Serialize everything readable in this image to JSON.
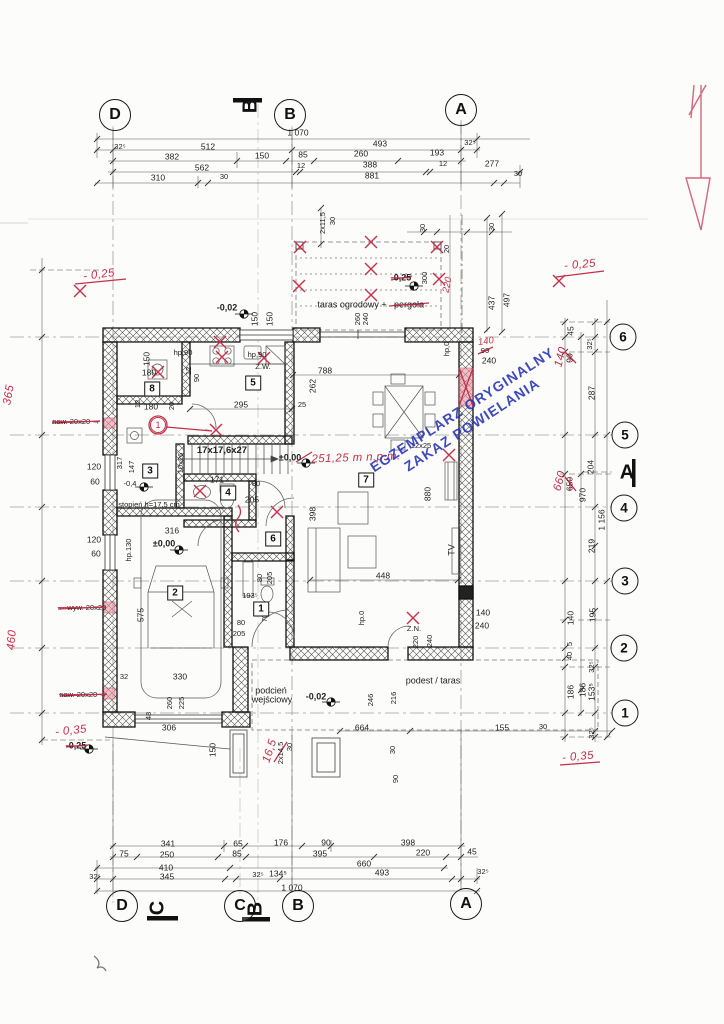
{
  "stamp": {
    "line1": "EGZEMPLARZ ORYGINALNY",
    "line2": "ZAKAZ POWIELANIA"
  },
  "bubbles": [
    {
      "t": "D",
      "x": 115,
      "y": 115
    },
    {
      "t": "B",
      "x": 290,
      "y": 115
    },
    {
      "t": "A",
      "x": 461,
      "y": 110
    },
    {
      "t": "D",
      "x": 122,
      "y": 906
    },
    {
      "t": "C",
      "x": 240,
      "y": 906
    },
    {
      "t": "B",
      "x": 298,
      "y": 906
    },
    {
      "t": "A",
      "x": 466,
      "y": 904
    },
    {
      "t": "6",
      "x": 623,
      "y": 337,
      "c": "s"
    },
    {
      "t": "5",
      "x": 625,
      "y": 435,
      "c": "s"
    },
    {
      "t": "4",
      "x": 624,
      "y": 508,
      "c": "s"
    },
    {
      "t": "3",
      "x": 625,
      "y": 581,
      "c": "s"
    },
    {
      "t": "2",
      "x": 624,
      "y": 648,
      "c": "s"
    },
    {
      "t": "1",
      "x": 625,
      "y": 713,
      "c": "s"
    }
  ],
  "sections": [
    {
      "t": "B",
      "x": 251,
      "y": 106,
      "r": -90
    },
    {
      "t": "C",
      "x": 158,
      "y": 908,
      "r": -90
    },
    {
      "t": "B",
      "x": 256,
      "y": 909,
      "r": -90
    },
    {
      "t": "A",
      "x": 627,
      "y": 473
    }
  ],
  "rooms": [
    {
      "t": "8",
      "x": 152,
      "y": 389
    },
    {
      "t": "5",
      "x": 253,
      "y": 383
    },
    {
      "t": "3",
      "x": 150,
      "y": 471
    },
    {
      "t": "4",
      "x": 228,
      "y": 493
    },
    {
      "t": "6",
      "x": 273,
      "y": 539
    },
    {
      "t": "2",
      "x": 175,
      "y": 593
    },
    {
      "t": "7",
      "x": 366,
      "y": 480
    },
    {
      "t": "1",
      "x": 261,
      "y": 609
    }
  ],
  "labels": [
    {
      "t": "1 070",
      "x": 298,
      "y": 133
    },
    {
      "t": "32⁵",
      "x": 120,
      "y": 147,
      "c": "sm"
    },
    {
      "t": "512",
      "x": 208,
      "y": 147
    },
    {
      "t": "493",
      "x": 380,
      "y": 144
    },
    {
      "t": "32⁵",
      "x": 470,
      "y": 143,
      "c": "sm"
    },
    {
      "t": "382",
      "x": 172,
      "y": 157
    },
    {
      "t": "150",
      "x": 262,
      "y": 156
    },
    {
      "t": "85",
      "x": 303,
      "y": 155
    },
    {
      "t": "260",
      "x": 361,
      "y": 154
    },
    {
      "t": "193",
      "x": 437,
      "y": 153
    },
    {
      "t": "562",
      "x": 202,
      "y": 168
    },
    {
      "t": "12",
      "x": 301,
      "y": 166,
      "c": "sm"
    },
    {
      "t": "388",
      "x": 370,
      "y": 165
    },
    {
      "t": "12",
      "x": 443,
      "y": 164,
      "c": "sm"
    },
    {
      "t": "277",
      "x": 492,
      "y": 164
    },
    {
      "t": "310",
      "x": 158,
      "y": 178
    },
    {
      "t": "30",
      "x": 224,
      "y": 177,
      "c": "sm"
    },
    {
      "t": "881",
      "x": 372,
      "y": 176
    },
    {
      "t": "30",
      "x": 518,
      "y": 174,
      "c": "sm"
    },
    {
      "t": "341",
      "x": 168,
      "y": 844
    },
    {
      "t": "65",
      "x": 238,
      "y": 844
    },
    {
      "t": "176",
      "x": 281,
      "y": 843
    },
    {
      "t": "90",
      "x": 326,
      "y": 843
    },
    {
      "t": "398",
      "x": 408,
      "y": 843
    },
    {
      "t": "75",
      "x": 124,
      "y": 854
    },
    {
      "t": "250",
      "x": 167,
      "y": 855
    },
    {
      "t": "85",
      "x": 237,
      "y": 854
    },
    {
      "t": "395",
      "x": 320,
      "y": 854
    },
    {
      "t": "220",
      "x": 423,
      "y": 853
    },
    {
      "t": "45",
      "x": 472,
      "y": 852
    },
    {
      "t": "410",
      "x": 166,
      "y": 868
    },
    {
      "t": "660",
      "x": 364,
      "y": 864
    },
    {
      "t": "32⁵",
      "x": 95,
      "y": 877,
      "c": "sm"
    },
    {
      "t": "345",
      "x": 167,
      "y": 877
    },
    {
      "t": "32⁵",
      "x": 258,
      "y": 875,
      "c": "sm"
    },
    {
      "t": "134⁵",
      "x": 278,
      "y": 874
    },
    {
      "t": "493",
      "x": 382,
      "y": 873
    },
    {
      "t": "32⁵",
      "x": 483,
      "y": 872,
      "c": "sm"
    },
    {
      "t": "1 070",
      "x": 292,
      "y": 888
    },
    {
      "t": "45",
      "x": 571,
      "y": 331,
      "r": -90
    },
    {
      "t": "32⁵",
      "x": 590,
      "y": 344,
      "r": -90,
      "c": "sm"
    },
    {
      "t": "90",
      "x": 570,
      "y": 358,
      "r": -90,
      "c": "strike"
    },
    {
      "t": "140",
      "x": 561,
      "y": 357,
      "r": -75,
      "c": "red",
      "n": "handwritten-correction"
    },
    {
      "t": "287",
      "x": 592,
      "y": 393,
      "r": -90
    },
    {
      "t": "204",
      "x": 591,
      "y": 467,
      "r": -90
    },
    {
      "t": "650",
      "x": 570,
      "y": 484,
      "r": -90,
      "c": "strike"
    },
    {
      "t": "660",
      "x": 560,
      "y": 481,
      "r": -75,
      "c": "red",
      "n": "handwritten-correction"
    },
    {
      "t": "970",
      "x": 583,
      "y": 495,
      "r": -90
    },
    {
      "t": "1 156",
      "x": 602,
      "y": 520,
      "r": -90
    },
    {
      "t": "219",
      "x": 592,
      "y": 546,
      "r": -90
    },
    {
      "t": "140",
      "x": 571,
      "y": 618,
      "r": -90
    },
    {
      "t": "195",
      "x": 593,
      "y": 615,
      "r": -90
    },
    {
      "t": "5",
      "x": 570,
      "y": 644,
      "r": -90,
      "c": "sm"
    },
    {
      "t": "40",
      "x": 570,
      "y": 656,
      "r": -90,
      "c": "sm"
    },
    {
      "t": "32⁵",
      "x": 592,
      "y": 667,
      "r": -90,
      "c": "sm"
    },
    {
      "t": "186",
      "x": 571,
      "y": 692,
      "r": -90
    },
    {
      "t": "186",
      "x": 583,
      "y": 690,
      "r": -90
    },
    {
      "t": "153⁵",
      "x": 592,
      "y": 692,
      "r": -90
    },
    {
      "t": "32⁵",
      "x": 592,
      "y": 733,
      "r": -90,
      "c": "sm"
    },
    {
      "t": "- 0,25",
      "x": 580,
      "y": 265,
      "r": -5,
      "c": "red",
      "n": "handwritten-level"
    },
    {
      "t": "- 0,35",
      "x": 578,
      "y": 757,
      "r": -5,
      "c": "red",
      "n": "handwritten-level"
    },
    {
      "t": "437",
      "x": 492,
      "y": 303,
      "r": -90
    },
    {
      "t": "497",
      "x": 507,
      "y": 300,
      "r": -90
    },
    {
      "t": "30",
      "x": 423,
      "y": 228,
      "r": -90,
      "c": "sm"
    },
    {
      "t": "30",
      "x": 492,
      "y": 227,
      "r": -90,
      "c": "sm"
    },
    {
      "t": "2x11,5",
      "x": 323,
      "y": 223,
      "r": -90,
      "c": "sm"
    },
    {
      "t": "30",
      "x": 333,
      "y": 221,
      "r": -90,
      "c": "sm"
    },
    {
      "t": "- 0,25",
      "x": 99,
      "y": 275,
      "r": -7,
      "c": "red",
      "n": "handwritten-level"
    },
    {
      "t": "365",
      "x": 9,
      "y": 395,
      "r": -80,
      "c": "red",
      "n": "handwritten-dim"
    },
    {
      "t": "460",
      "x": 12,
      "y": 640,
      "r": -85,
      "c": "red",
      "n": "handwritten-dim"
    },
    {
      "t": "- 0,35",
      "x": 71,
      "y": 731,
      "r": -6,
      "c": "red",
      "n": "handwritten-level"
    },
    {
      "t": "-0,25",
      "x": 76,
      "y": 746,
      "c": "strike lvl"
    },
    {
      "t": "naw. 20x20 →",
      "x": 76,
      "y": 422,
      "c": "sm strike"
    },
    {
      "t": "← wyw. 20x20",
      "x": 82,
      "y": 608,
      "c": "sm strike"
    },
    {
      "t": "naw. 20x20 →",
      "x": 83,
      "y": 695,
      "c": "sm strike"
    },
    {
      "t": "120",
      "x": 94,
      "y": 467
    },
    {
      "t": "60",
      "x": 95,
      "y": 482
    },
    {
      "t": "120",
      "x": 94,
      "y": 540
    },
    {
      "t": "60",
      "x": 96,
      "y": 554
    },
    {
      "t": "hp.130",
      "x": 129,
      "y": 550,
      "r": -90,
      "c": "sm"
    },
    {
      "t": "-0,02",
      "x": 227,
      "y": 308,
      "c": "lvl",
      "n": "level-label"
    },
    {
      "t": "150",
      "x": 255,
      "y": 319,
      "r": -90
    },
    {
      "t": "150",
      "x": 270,
      "y": 319,
      "r": -90
    },
    {
      "t": "taras ogrodowy +",
      "x": 352,
      "y": 305,
      "c": "md",
      "n": "room-label"
    },
    {
      "t": "pergola",
      "x": 409,
      "y": 305,
      "c": "md strike",
      "n": "room-label"
    },
    {
      "t": "-0,25",
      "x": 401,
      "y": 278,
      "c": "strike lvl"
    },
    {
      "t": "300",
      "x": 425,
      "y": 278,
      "r": -90,
      "c": "sm"
    },
    {
      "t": "220",
      "x": 448,
      "y": 285,
      "r": -78,
      "c": "redsm"
    },
    {
      "t": "20",
      "x": 447,
      "y": 249,
      "r": -90,
      "c": "sm"
    },
    {
      "t": "260",
      "x": 358,
      "y": 319,
      "r": -90,
      "c": "sm"
    },
    {
      "t": "240",
      "x": 366,
      "y": 319,
      "r": -90,
      "c": "sm"
    },
    {
      "t": "hp,90",
      "x": 183,
      "y": 353,
      "c": "sm"
    },
    {
      "t": "150",
      "x": 147,
      "y": 359,
      "r": -90
    },
    {
      "t": "180",
      "x": 149,
      "y": 373
    },
    {
      "t": "180",
      "x": 151,
      "y": 407
    },
    {
      "t": "12",
      "x": 138,
      "y": 404,
      "r": -90,
      "c": "sm"
    },
    {
      "t": "20",
      "x": 172,
      "y": 406,
      "r": -90,
      "c": "sm"
    },
    {
      "t": "hp,90",
      "x": 257,
      "y": 355,
      "c": "sm"
    },
    {
      "t": "Z.W.",
      "x": 263,
      "y": 367,
      "c": "sm"
    },
    {
      "t": "788",
      "x": 325,
      "y": 371
    },
    {
      "t": "262",
      "x": 313,
      "y": 386,
      "r": -90
    },
    {
      "t": "295",
      "x": 241,
      "y": 405
    },
    {
      "t": "25",
      "x": 302,
      "y": 405,
      "c": "sm"
    },
    {
      "t": "12",
      "x": 189,
      "y": 371,
      "r": -90,
      "c": "sm"
    },
    {
      "t": "90",
      "x": 197,
      "y": 378,
      "r": -90,
      "c": "sm"
    },
    {
      "t": "hp,0",
      "x": 447,
      "y": 349,
      "r": -90,
      "c": "sm"
    },
    {
      "t": "140",
      "x": 486,
      "y": 342,
      "r": -8,
      "c": "redsm",
      "n": "handwritten-correction"
    },
    {
      "t": "90",
      "x": 485,
      "y": 351,
      "c": "strike sm"
    },
    {
      "t": "240",
      "x": 489,
      "y": 361
    },
    {
      "t": "12x25",
      "x": 421,
      "y": 446,
      "c": "sm"
    },
    {
      "t": "17x17,6x27",
      "x": 222,
      "y": 451,
      "c": "bold",
      "n": "stair-label"
    },
    {
      "t": "10x26",
      "x": 181,
      "y": 463,
      "r": -90,
      "c": "sm"
    },
    {
      "t": "±0,00",
      "x": 290,
      "y": 458,
      "c": "lvl",
      "n": "level-label"
    },
    {
      "t": "251,25 m n.p.m.",
      "x": 356,
      "y": 458,
      "r": -2,
      "c": "red",
      "n": "handwritten-note"
    },
    {
      "t": "317",
      "x": 120,
      "y": 463,
      "r": -90,
      "c": "sm"
    },
    {
      "t": "147",
      "x": 132,
      "y": 467,
      "r": -90,
      "c": "sm"
    },
    {
      "t": "-0,4",
      "x": 130,
      "y": 484,
      "c": "sm"
    },
    {
      "t": "171",
      "x": 217,
      "y": 480
    },
    {
      "t": "80",
      "x": 256,
      "y": 484,
      "c": "sm"
    },
    {
      "t": "205",
      "x": 252,
      "y": 500
    },
    {
      "t": "stopień h=17,5 cm",
      "x": 149,
      "y": 505,
      "c": "sm",
      "n": "step-note"
    },
    {
      "t": "316",
      "x": 172,
      "y": 531
    },
    {
      "t": "±0,00",
      "x": 164,
      "y": 544,
      "c": "lvl",
      "n": "level-label"
    },
    {
      "t": "575",
      "x": 141,
      "y": 615,
      "r": -90
    },
    {
      "t": "80",
      "x": 260,
      "y": 578,
      "r": -90,
      "c": "sm"
    },
    {
      "t": "205",
      "x": 270,
      "y": 578,
      "r": -90,
      "c": "sm"
    },
    {
      "t": "193⁵",
      "x": 250,
      "y": 596,
      "c": "sm"
    },
    {
      "t": "70",
      "x": 265,
      "y": 618,
      "r": -90,
      "c": "sm"
    },
    {
      "t": "80",
      "x": 241,
      "y": 623,
      "c": "sm"
    },
    {
      "t": "205",
      "x": 239,
      "y": 634,
      "c": "sm"
    },
    {
      "t": "398",
      "x": 313,
      "y": 514,
      "r": -90
    },
    {
      "t": "880",
      "x": 428,
      "y": 494,
      "r": -90
    },
    {
      "t": "448",
      "x": 383,
      "y": 576
    },
    {
      "t": "TV",
      "x": 452,
      "y": 550,
      "r": -90,
      "c": "md"
    },
    {
      "t": "Z.N.",
      "x": 414,
      "y": 629,
      "c": "sm"
    },
    {
      "t": "hp.0",
      "x": 362,
      "y": 618,
      "r": -90,
      "c": "sm"
    },
    {
      "t": "140",
      "x": 483,
      "y": 613
    },
    {
      "t": "240",
      "x": 482,
      "y": 626
    },
    {
      "t": "220",
      "x": 416,
      "y": 642,
      "r": -90,
      "c": "sm"
    },
    {
      "t": "240",
      "x": 430,
      "y": 641,
      "r": -90,
      "c": "sm"
    },
    {
      "t": "podest / taras",
      "x": 433,
      "y": 681,
      "c": "md",
      "n": "room-label"
    },
    {
      "t": "246",
      "x": 371,
      "y": 700,
      "r": -90,
      "c": "sm"
    },
    {
      "t": "216",
      "x": 394,
      "y": 698,
      "r": -90,
      "c": "sm"
    },
    {
      "t": "664",
      "x": 362,
      "y": 728
    },
    {
      "t": "155",
      "x": 502,
      "y": 728
    },
    {
      "t": "30",
      "x": 543,
      "y": 727,
      "c": "sm"
    },
    {
      "t": "podcień",
      "x": 271,
      "y": 691,
      "c": "md",
      "n": "room-label"
    },
    {
      "t": "wejściowy",
      "x": 272,
      "y": 700,
      "c": "md",
      "n": "room-label"
    },
    {
      "t": "-0,02",
      "x": 316,
      "y": 697,
      "c": "lvl",
      "n": "level-label"
    },
    {
      "t": "330",
      "x": 180,
      "y": 677
    },
    {
      "t": "32",
      "x": 124,
      "y": 677,
      "c": "sm"
    },
    {
      "t": "48",
      "x": 149,
      "y": 716,
      "r": -90,
      "c": "sm"
    },
    {
      "t": "260",
      "x": 170,
      "y": 703,
      "r": -90,
      "c": "sm"
    },
    {
      "t": "225",
      "x": 182,
      "y": 703,
      "r": -90,
      "c": "sm"
    },
    {
      "t": "306",
      "x": 169,
      "y": 728
    },
    {
      "t": "150",
      "x": 213,
      "y": 750,
      "r": -90
    },
    {
      "t": "16,5",
      "x": 270,
      "y": 751,
      "r": -72,
      "c": "red",
      "n": "handwritten-correction"
    },
    {
      "t": "2x14,5",
      "x": 281,
      "y": 753,
      "r": -90,
      "c": "sm"
    },
    {
      "t": "30",
      "x": 290,
      "y": 747,
      "r": -90,
      "c": "sm"
    },
    {
      "t": "30",
      "x": 393,
      "y": 750,
      "r": -90,
      "c": "sm"
    },
    {
      "t": "90",
      "x": 396,
      "y": 779,
      "r": -90,
      "c": "sm"
    },
    {
      "t": "1",
      "x": 158,
      "y": 425,
      "c": "redc",
      "n": "revision-mark"
    }
  ]
}
